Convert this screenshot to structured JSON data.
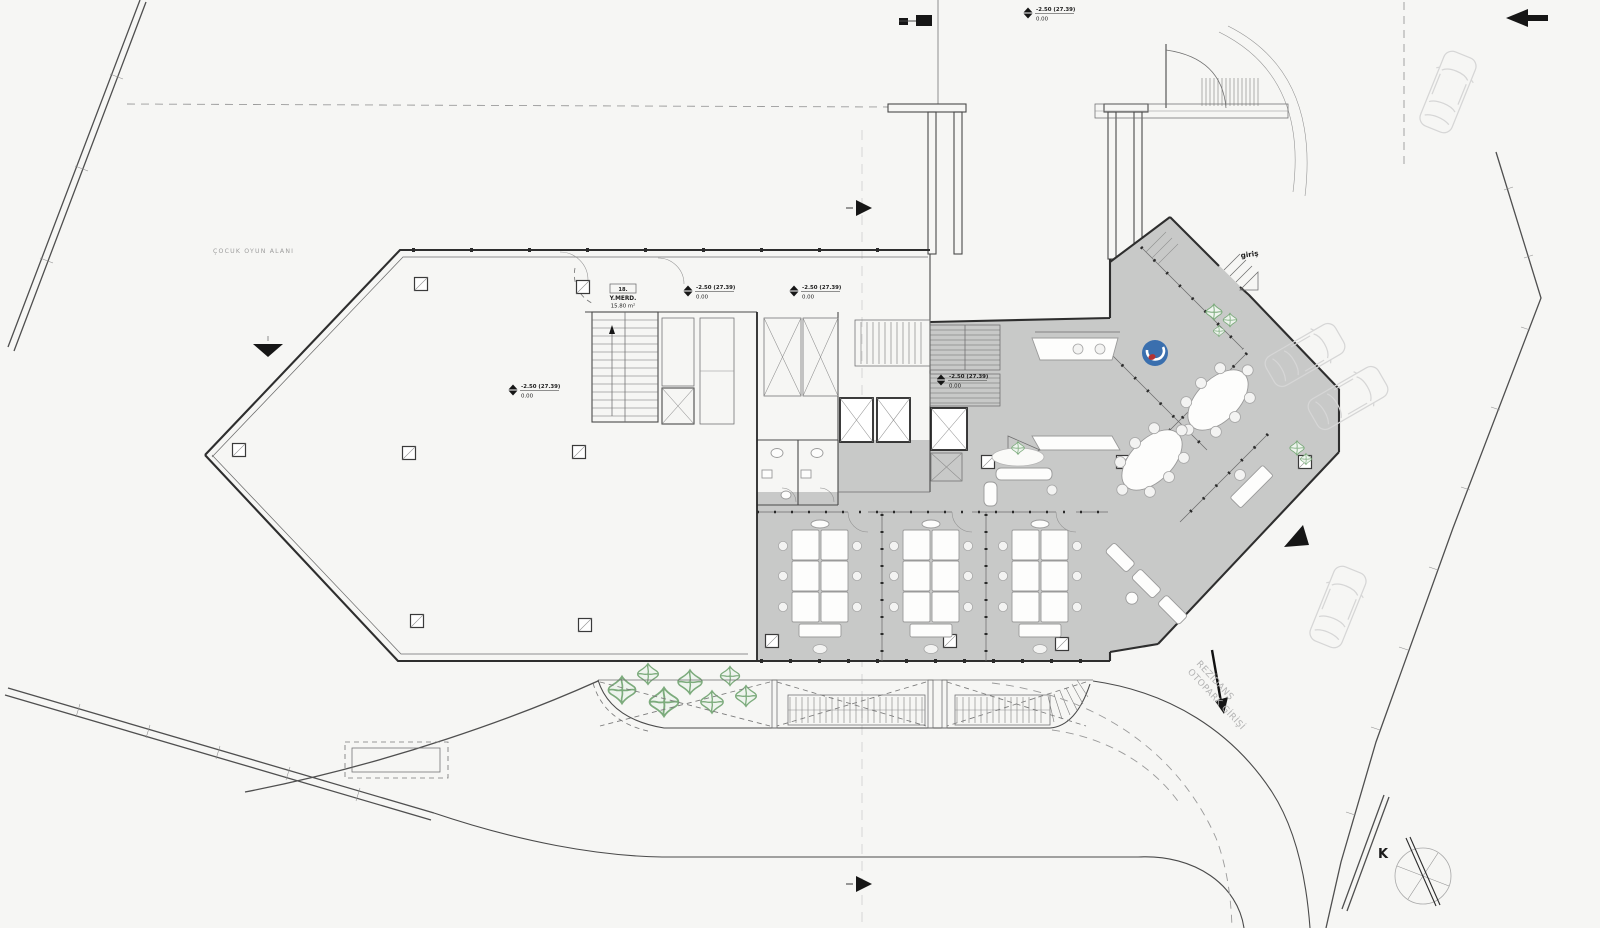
{
  "plan": {
    "labels": {
      "play_area": "ÇOCUK OYUN ALANI",
      "entrance": "giriş",
      "ramp_line1": "REZİDANS",
      "ramp_line2": "OTOPARK GİRİŞİ",
      "north": "K",
      "stair_number": "18.",
      "stair_name": "Y.MERD.",
      "stair_area": "15.80 m²"
    },
    "elevation_marker": {
      "level": "-2.50 (27.39)",
      "datum": "0.00"
    },
    "colors": {
      "background": "#f6f6f4",
      "floor_gray": "#c8c9c8",
      "wall": "#2e2e2e",
      "plant_green": "#7cab7c",
      "logo_blue": "#3a6fae",
      "logo_red": "#b23333",
      "car_outline": "#d6d6d6"
    }
  }
}
